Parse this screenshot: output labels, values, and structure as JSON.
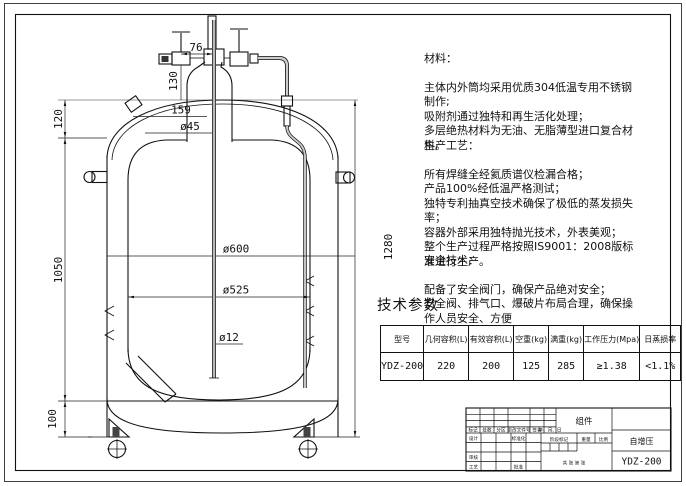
{
  "page": {
    "background": "#ffffff",
    "line_color": "#111111",
    "construction_line_color": "#9a9a9a"
  },
  "drawing": {
    "dims": {
      "valve_offset": "76",
      "neck_height": "130",
      "head_height": "120",
      "flange_width": "159",
      "neck_dia": "ø45",
      "outer_dia": "ø600",
      "inner_dia": "ø525",
      "tube_dia": "ø12",
      "body_height": "1050",
      "overall_height": "1280",
      "base_height": "100"
    }
  },
  "notes": {
    "material": {
      "title": "材料：",
      "body": "主体内外筒均采用优质304低温专用不锈钢\n制作;\n吸附剂通过独特和再生活化处理；\n多层绝热材料为无油、无脂薄型进口复合材\n料。"
    },
    "process": {
      "title": "生产工艺：",
      "body": "所有焊缝全经氦质谱仪检漏合格；\n产品100%经低温严格测试；\n独特专利抽真空技术确保了极低的蒸发损失\n率；\n容器外部采用独特抛光技术，外表美观；\n整个生产过程严格按照IS9001：2008版标\n准进行生产。"
    },
    "safety": {
      "title": "安全技术：",
      "body": "配备了安全阀门，确保产品绝对安全；\n安全阀、排气口、爆破片布局合理，确保操\n作人员安全、方便"
    }
  },
  "spec_table": {
    "title": "技术参数",
    "headers": [
      "型号",
      "几何容积(L)",
      "有效容积(L)",
      "空重(kg)",
      "满重(kg)",
      "工作压力(Mpa)",
      "日蒸损率"
    ],
    "rows": [
      [
        "YDZ-200",
        "220",
        "200",
        "125",
        "285",
        "≥1.38",
        "<1.1%"
      ]
    ]
  },
  "title_block": {
    "part_name": "组件",
    "series_name": "自增压",
    "model": "YDZ-200",
    "revision_headers": [
      "标记",
      "处数",
      "分区",
      "更改文件号",
      "签名",
      "年、月、日"
    ],
    "role_design": "设计",
    "role_standard": "标准化",
    "role_review": "审核",
    "role_process": "工艺",
    "role_approve": "批准",
    "stage_mark": "阶段标记",
    "weight": "重量",
    "scale": "比例",
    "sheet_text": "共  张  第  张"
  }
}
